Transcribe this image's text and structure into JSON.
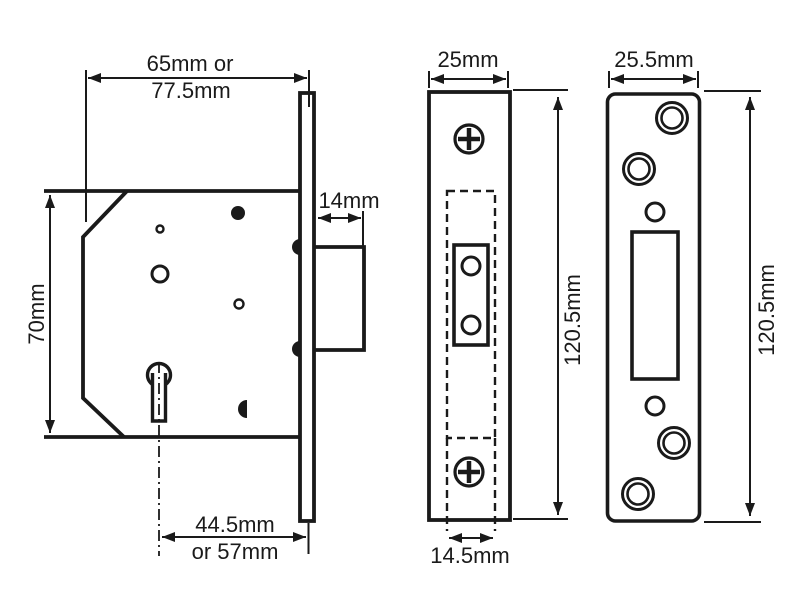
{
  "drawing": {
    "background": "#ffffff",
    "line_color": "#1a1a1a",
    "lock_body": {
      "case_width_line1": "65mm or",
      "case_width_line2": "77.5mm",
      "case_height": "70mm",
      "bolt_throw": "14mm",
      "backset_line1": "44.5mm",
      "backset_line2": "or 57mm"
    },
    "faceplate": {
      "width": "25mm",
      "height": "120.5mm",
      "case_thickness": "14.5mm"
    },
    "strike_plate": {
      "width": "25.5mm",
      "height": "120.5mm"
    }
  }
}
